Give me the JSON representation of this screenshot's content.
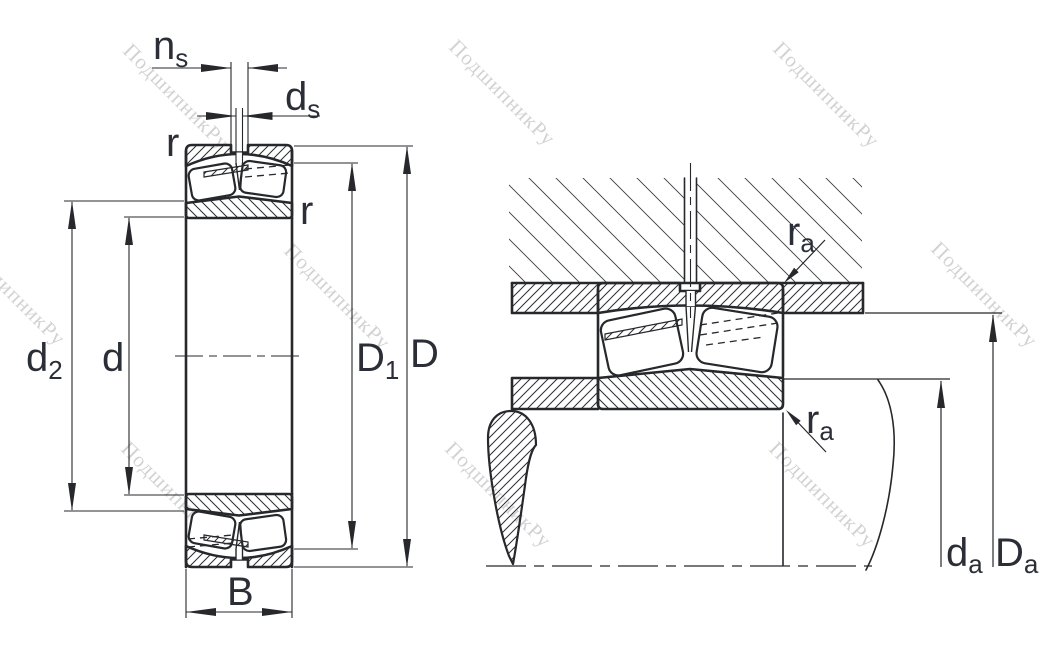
{
  "watermark": {
    "text": "ПодшипникРу",
    "color": "#d2d2d2"
  },
  "drawing": {
    "colors": {
      "line": "#26282c",
      "label": "#2b2e36"
    },
    "labels": {
      "n_s": {
        "base": "n",
        "sub": "s"
      },
      "d_s": {
        "base": "d",
        "sub": "s"
      },
      "r": "r",
      "d_2": {
        "base": "d",
        "sub": "2"
      },
      "d": "d",
      "D_1": {
        "base": "D",
        "sub": "1"
      },
      "D": "D",
      "B": "B",
      "r_a": {
        "base": "r",
        "sub": "a"
      },
      "d_a": {
        "base": "d",
        "sub": "a"
      },
      "D_a": {
        "base": "D",
        "sub": "a"
      }
    }
  }
}
